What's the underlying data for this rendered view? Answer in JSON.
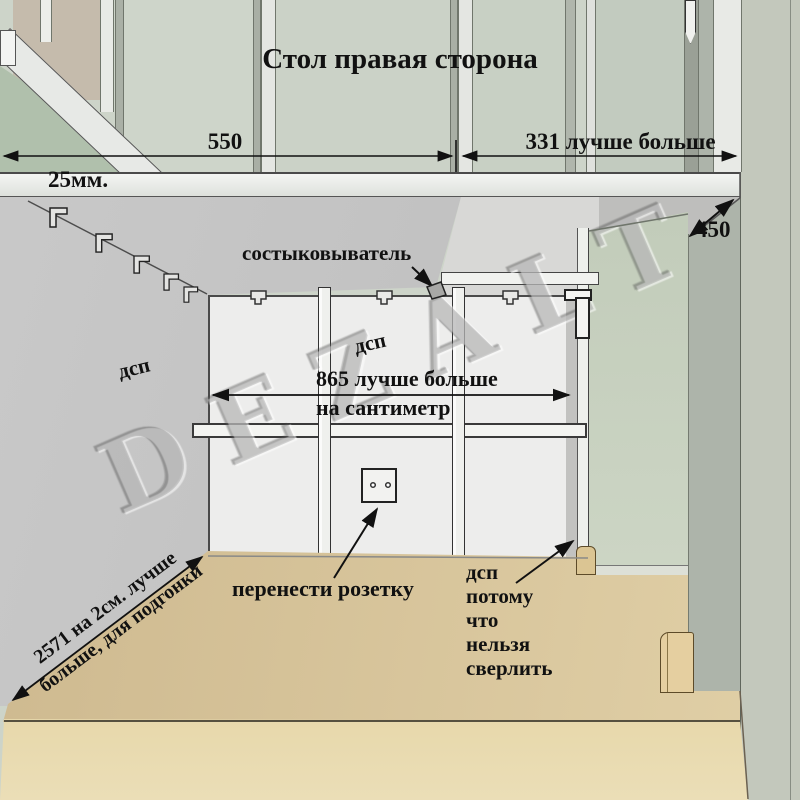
{
  "title": "Стол правая сторона",
  "watermark": "DEZALT",
  "dims": {
    "d550": "550",
    "d331": "331 лучше больше",
    "d25": "25мм.",
    "d450": "450",
    "d865_line1": "865 лучше больше",
    "d865_line2": "на сантиметр",
    "d2571_line1": "2571 на 2см. лучше",
    "d2571_line2": "больше, для подгонки"
  },
  "labels": {
    "connector": "состыковыватель",
    "dsp_left": "дсп",
    "dsp_middle": "дсп",
    "outlet_note": "перенести розетку",
    "dsp_right": {
      "l1": "дсп",
      "l2": "потому",
      "l3": "что",
      "l4": "нельзя",
      "l5": "сверлить"
    }
  },
  "colors": {
    "ink": "#111111",
    "pane": "#ccd3c8",
    "wall-grey": "#c2c2c2",
    "back-wall": "#ededec",
    "green-wall": "#c7d1c0",
    "floor": "#d8c399",
    "bench": "#e8dab0",
    "wood-trim": "#5d4b29"
  }
}
